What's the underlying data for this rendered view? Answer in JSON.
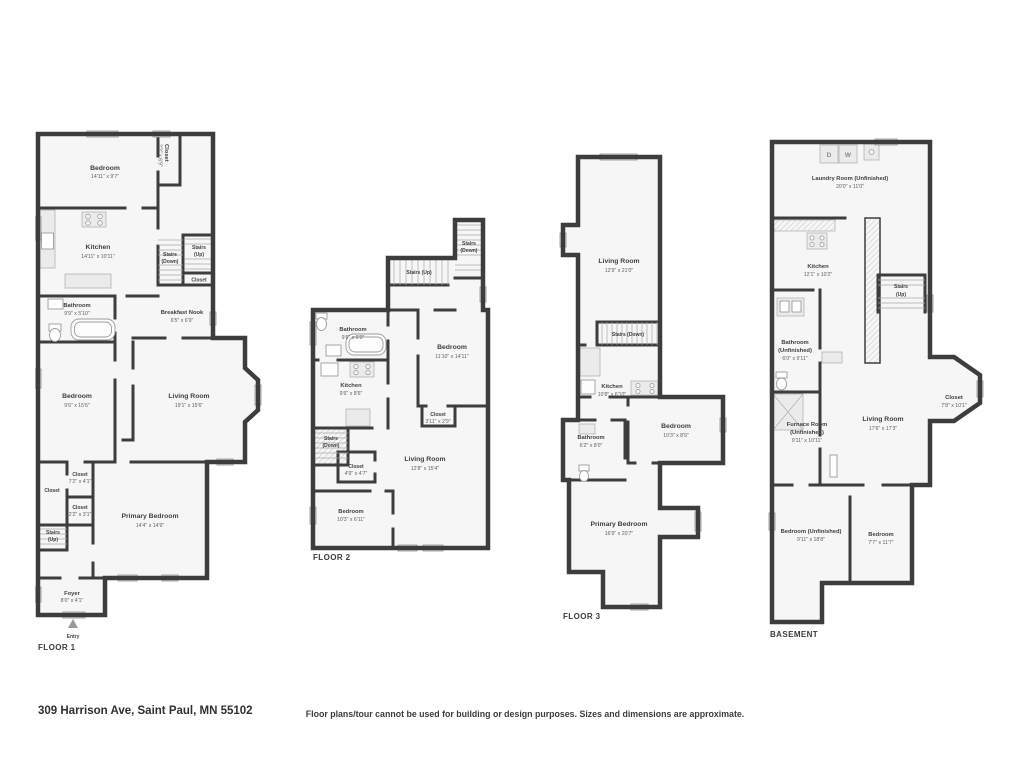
{
  "meta": {
    "address": "309 Harrison Ave, Saint Paul, MN 55102",
    "disclaimer": "Floor plans/tour cannot be used for building or design purposes. Sizes and dimensions are approximate.",
    "wall_color": "#3d3d3d",
    "room_fill": "#f6f6f6"
  },
  "f1": {
    "label": "FLOOR 1",
    "entry": "Entry",
    "rooms": {
      "bedroom_top": {
        "name": "Bedroom",
        "dims": "14'11\" x 9'7\""
      },
      "closet_rot": {
        "name": "Closet",
        "dims": "2'2\" x 6'9\""
      },
      "kitchen": {
        "name": "Kitchen",
        "dims": "14'11\" x 10'11\""
      },
      "stairs_down": {
        "name": "Stairs",
        "dims": "(Down)"
      },
      "stairs_up": {
        "name": "Stairs",
        "dims": "(Up)"
      },
      "closet_stairs": {
        "name": "Closet",
        "dims": ""
      },
      "breakfast_nook": {
        "name": "Breakfast Nook",
        "dims": "6'5\" x 6'9\""
      },
      "bathroom": {
        "name": "Bathroom",
        "dims": "9'9\" x 5'10\""
      },
      "bedroom_mid": {
        "name": "Bedroom",
        "dims": "9'6\" x 15'6\""
      },
      "living_room": {
        "name": "Living Room",
        "dims": "19'1\" x 15'6\""
      },
      "closet1": {
        "name": "Closet",
        "dims": "7'2\" x 4'1\""
      },
      "closet_left": {
        "name": "Closet",
        "dims": ""
      },
      "closet2": {
        "name": "Closet",
        "dims": "2'2\" x 3'1\""
      },
      "stairs_up2": {
        "name": "Stairs",
        "dims": "(Up)"
      },
      "primary": {
        "name": "Primary Bedroom",
        "dims": "14'4\" x 14'9\""
      },
      "foyer": {
        "name": "Foyer",
        "dims": "8'0\" x 4'1\""
      }
    }
  },
  "f2": {
    "label": "FLOOR 2",
    "rooms": {
      "stairs_down_top": {
        "name": "Stairs",
        "dims": "(Down)"
      },
      "stairs_up": {
        "name": "Stairs (Up)",
        "dims": ""
      },
      "bathroom": {
        "name": "Bathroom",
        "dims": "9'6\" x 6'0\""
      },
      "bedroom_right": {
        "name": "Bedroom",
        "dims": "11'10\" x 14'11\""
      },
      "kitchen": {
        "name": "Kitchen",
        "dims": "9'6\" x 8'6\""
      },
      "closet_right": {
        "name": "Closet",
        "dims": "3'11\" x 2'9\""
      },
      "stairs_down_left": {
        "name": "Stairs",
        "dims": "(Down)"
      },
      "closet_mid": {
        "name": "Closet",
        "dims": "4'9\" x 4'7\""
      },
      "living_room": {
        "name": "Living Room",
        "dims": "12'8\" x 15'4\""
      },
      "bedroom_bottom": {
        "name": "Bedroom",
        "dims": "10'3\" x 6'11\""
      }
    }
  },
  "f3": {
    "label": "FLOOR 3",
    "rooms": {
      "living_room": {
        "name": "Living Room",
        "dims": "12'9\" x 21'0\""
      },
      "stairs_down": {
        "name": "Stairs (Down)",
        "dims": ""
      },
      "kitchen": {
        "name": "Kitchen",
        "dims": "10'8\" x 6'10\""
      },
      "bathroom": {
        "name": "Bathroom",
        "dims": "6'2\" x 8'0\""
      },
      "bedroom": {
        "name": "Bedroom",
        "dims": "10'3\" x 8'9\""
      },
      "primary": {
        "name": "Primary Bedroom",
        "dims": "16'9\" x 20'7\""
      }
    }
  },
  "f4": {
    "label": "BASEMENT",
    "appliances": {
      "dryer": "D",
      "washer": "W"
    },
    "rooms": {
      "laundry": {
        "name": "Laundry Room (Unfinished)",
        "dims": "20'0\" x 11'0\""
      },
      "kitchen": {
        "name": "Kitchen",
        "dims": "12'1\" x 10'2\""
      },
      "stairs_up": {
        "name": "Stairs",
        "dims": "(Up)"
      },
      "bathroom": {
        "name": "Bathroom",
        "name2": "(Unfinished)",
        "dims": "6'0\" x 9'11\""
      },
      "furnace": {
        "name": "Furnace Room",
        "name2": "(Unfinished)",
        "dims": "9'11\" x 10'11\""
      },
      "living_room": {
        "name": "Living Room",
        "dims": "17'6\" x 17'3\""
      },
      "closet": {
        "name": "Closet",
        "dims": "7'8\" x 10'1\""
      },
      "bedroom_unf": {
        "name": "Bedroom (Unfinished)",
        "dims": "9'11\" x 18'8\""
      },
      "bedroom": {
        "name": "Bedroom",
        "dims": "7'7\" x 11'7\""
      }
    }
  }
}
